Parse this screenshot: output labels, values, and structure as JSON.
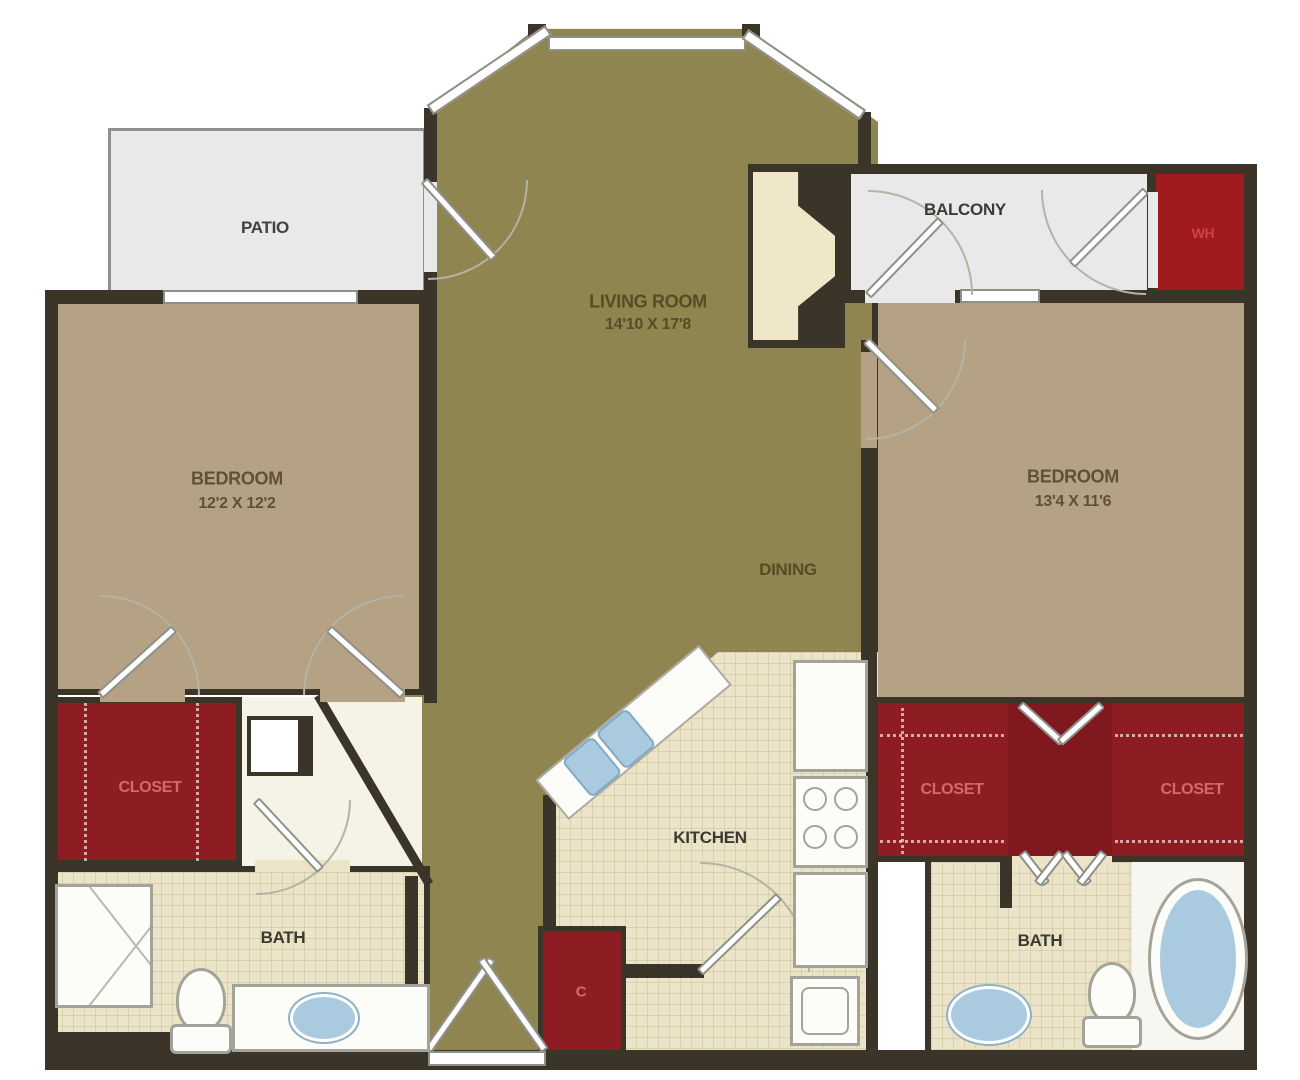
{
  "title": "Two Bedroom Apartment Floor Plan",
  "colors": {
    "wall": "#3b3429",
    "living_floor": "#8e8551",
    "bedroom_floor": "#b5a184",
    "outdoor_floor": "#e9e9ea",
    "closet_floor": "#8e1d23",
    "closet_floor_dark": "#7f191f",
    "water_heater_floor": "#a01b1e",
    "tile_floor": "#ece4c8",
    "accent_text": "#d4696b",
    "water": "#a9cadf"
  },
  "rooms": {
    "patio": {
      "label": "PATIO"
    },
    "balcony": {
      "label": "BALCONY"
    },
    "water_heater": {
      "label": "WH"
    },
    "living": {
      "label": "LIVING ROOM",
      "dims": "14'10 X 17'8"
    },
    "dining": {
      "label": "DINING"
    },
    "bedroom_left": {
      "label": "BEDROOM",
      "dims": "12'2 X 12'2"
    },
    "bedroom_right": {
      "label": "BEDROOM",
      "dims": "13'4 X 11'6"
    },
    "closet_left": {
      "label": "CLOSET"
    },
    "closet_right_inner": {
      "label": "CLOSET"
    },
    "closet_right_outer": {
      "label": "CLOSET"
    },
    "kitchen": {
      "label": "KITCHEN"
    },
    "bath_left": {
      "label": "BATH"
    },
    "bath_right": {
      "label": "BATH"
    },
    "coat_closet": {
      "label": "C"
    }
  },
  "fixtures": [
    "shower",
    "toilet",
    "vanity-sink",
    "bathtub",
    "kitchen-sink",
    "stove",
    "refrigerator",
    "washer",
    "fireplace"
  ]
}
